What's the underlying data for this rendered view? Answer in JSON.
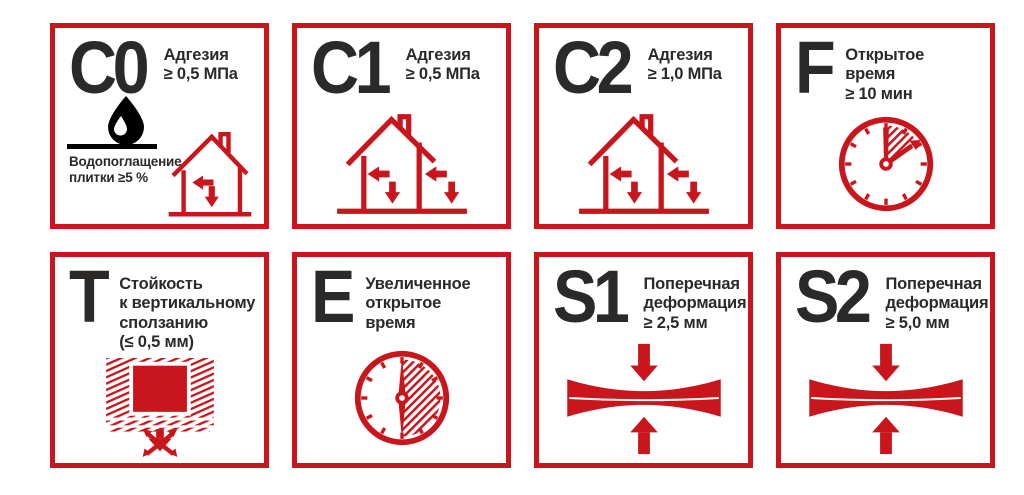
{
  "colors": {
    "red": "#C8161C",
    "dark": "#2B2A29",
    "white": "#FFFFFF"
  },
  "tiles": [
    {
      "code": "C0",
      "label": "Адгезия\n≥ 0,5 МПа",
      "note": "Водопоглащение\nплитки ≥5 %",
      "icon": "water-drop-and-house"
    },
    {
      "code": "C1",
      "label": "Адгезия\n≥ 0,5 МПа",
      "icon": "house-with-arrows"
    },
    {
      "code": "C2",
      "label": "Адгезия\n≥ 1,0 МПа",
      "icon": "house-with-arrows"
    },
    {
      "code": "F",
      "label": "Открытое\nвремя\n≥ 10 мин",
      "icon": "clock-open-time"
    },
    {
      "code": "T",
      "label": "Стойкость\nк вертикальному\nсползанию\n(≤ 0,5 мм)",
      "icon": "wall-tile-no-slip"
    },
    {
      "code": "E",
      "label": "Увеличенное\nоткрытое\nвремя",
      "icon": "clock-extended-time"
    },
    {
      "code": "S1",
      "label": "Поперечная\nдеформация\n≥ 2,5 мм",
      "icon": "beam-transverse-deformation"
    },
    {
      "code": "S2",
      "label": "Поперечная\nдеформация\n≥ 5,0 мм",
      "icon": "beam-transverse-deformation"
    }
  ]
}
